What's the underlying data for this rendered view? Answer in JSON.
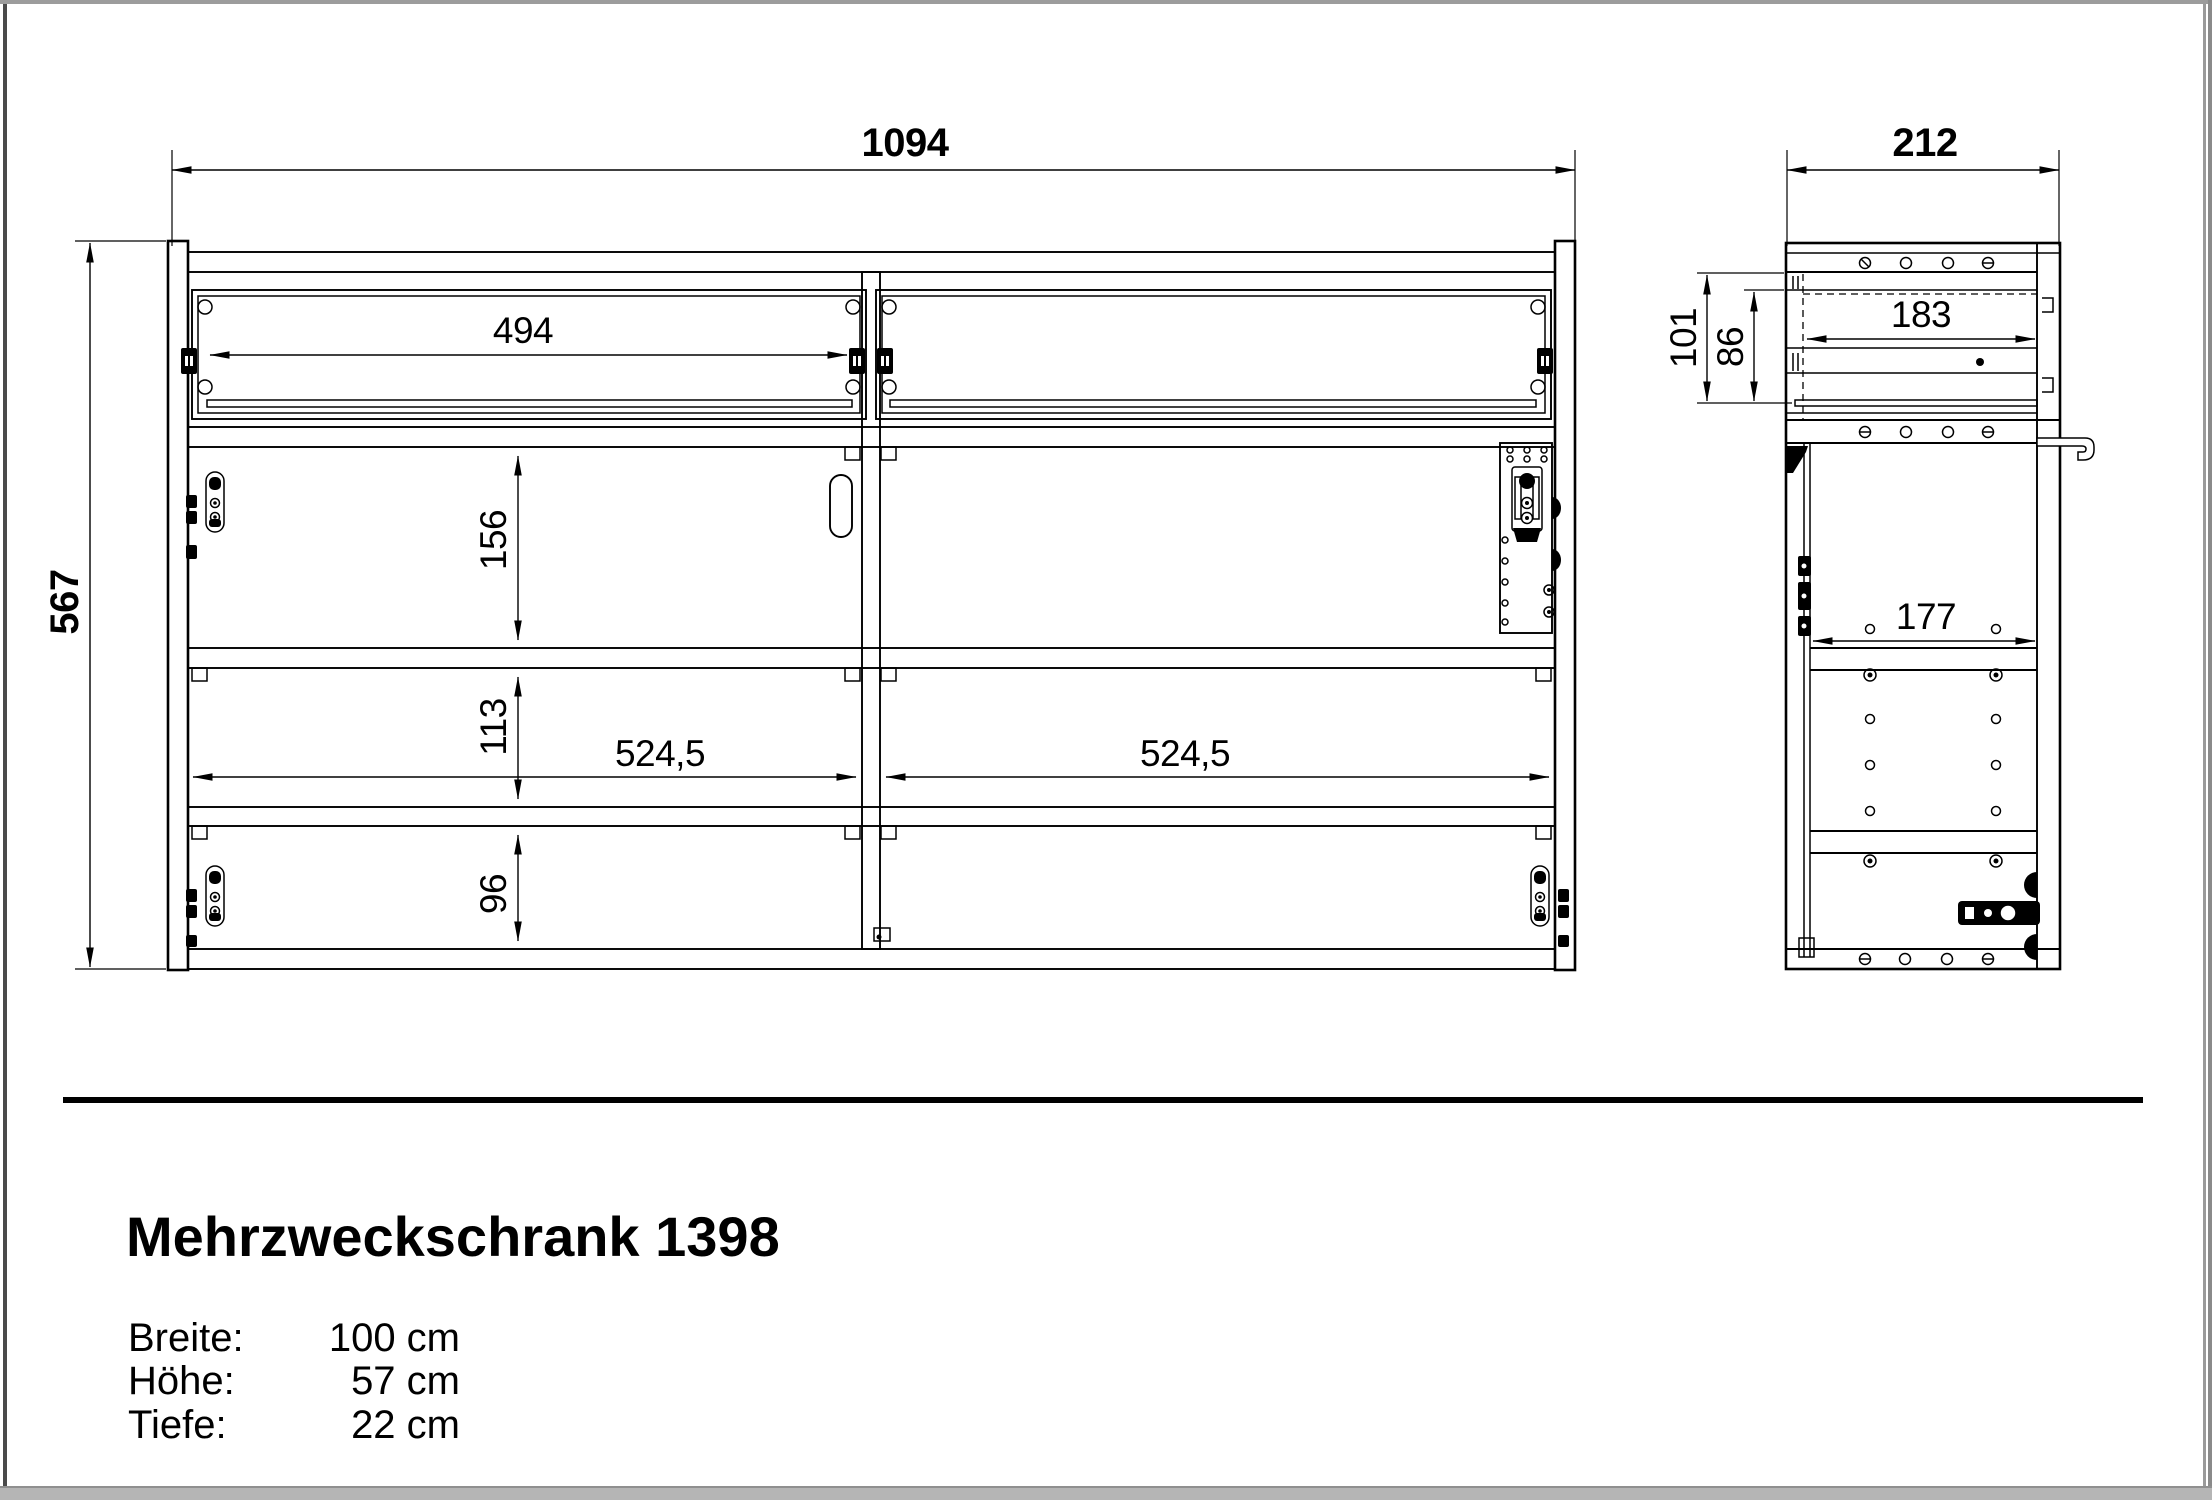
{
  "colors": {
    "line": "#000000",
    "background": "#ffffff",
    "border_top": "#9c9c9c",
    "border_left": "#4a4a4a",
    "border_right": "#9a9a9a",
    "border_bottom": "#b5b5b5"
  },
  "front_view": {
    "dimensions": {
      "overall_width": "1094",
      "overall_height": "567",
      "drawer_cutout_width": "494",
      "upper_compartment_height": "156",
      "middle_compartment_height": "113",
      "lower_compartment_height": "96",
      "left_compartment_width": "524,5",
      "right_compartment_width": "524,5"
    }
  },
  "side_view": {
    "dimensions": {
      "overall_depth": "212",
      "drawer_zone_height": "101",
      "drawer_front_height": "86",
      "drawer_inner_depth": "183",
      "compartment_inner_depth": "177"
    }
  },
  "info_block": {
    "title": "Mehrzweckschrank 1398",
    "specs": [
      {
        "label": "Breite:",
        "value": "100 cm"
      },
      {
        "label": "Höhe:",
        "value": "57 cm"
      },
      {
        "label": "Tiefe:",
        "value": "22 cm"
      }
    ]
  }
}
